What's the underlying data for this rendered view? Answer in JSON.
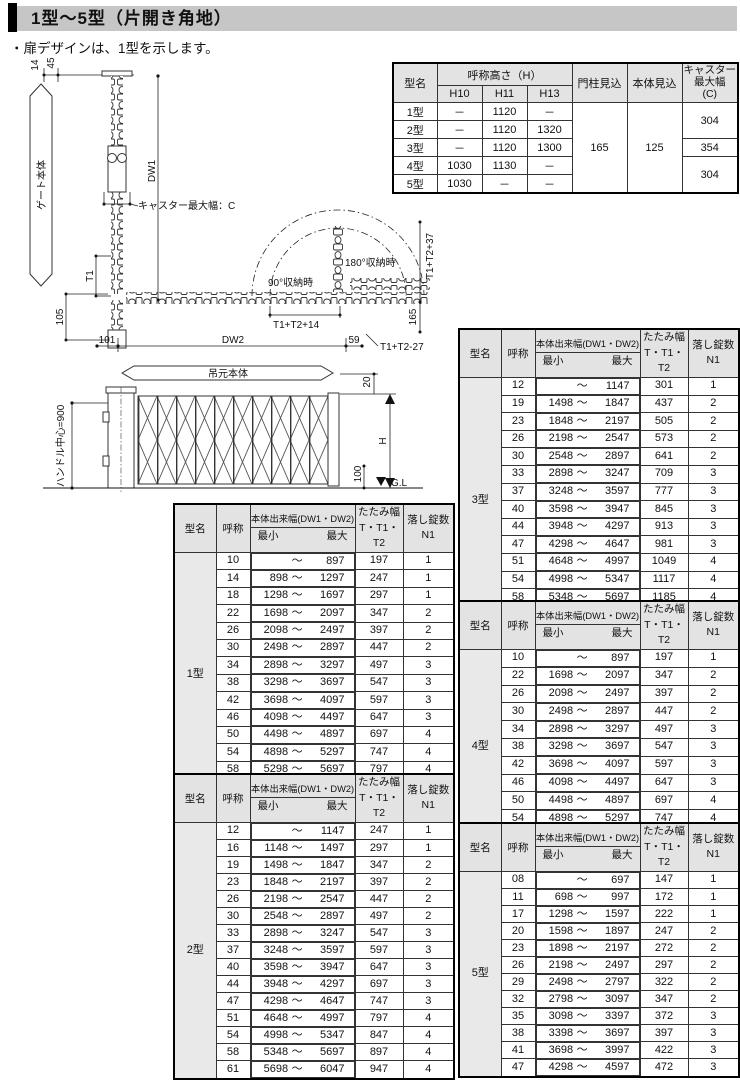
{
  "page": {
    "title": "1型～5型（片開き角地）",
    "note": "・扉デザインは、1型を示します。"
  },
  "spec_table": {
    "col_model": "型名",
    "col_height": "呼称高さ（H）",
    "col_h10": "H10",
    "col_h11": "H11",
    "col_h13": "H13",
    "col_post": "門柱見込",
    "col_body": "本体見込",
    "col_caster": "キャスター\n最大幅\n(C)",
    "rows": [
      [
        "1型",
        "－",
        "1120",
        "－"
      ],
      [
        "2型",
        "－",
        "1120",
        "1320"
      ],
      [
        "3型",
        "－",
        "1120",
        "1300"
      ],
      [
        "4型",
        "1030",
        "1130",
        "－"
      ],
      [
        "5型",
        "1030",
        "－",
        "－"
      ]
    ],
    "post_value": "165",
    "body_value": "125",
    "caster_values": [
      "304",
      "354",
      "304"
    ]
  },
  "item_table_header": {
    "model": "型名",
    "name": "呼称",
    "range": "本体出来幅(DW1・DW2)",
    "min": "最小",
    "max": "最大",
    "tilde": "～",
    "fold": "たたみ幅",
    "fold_sub": "T・T1・T2",
    "lock": "落し錠数",
    "lock_sub": "N1"
  },
  "type_tables": {
    "t1": {
      "model": "1型",
      "rows": [
        [
          "10",
          "",
          "897",
          "197",
          "1"
        ],
        [
          "14",
          "898",
          "1297",
          "247",
          "1"
        ],
        [
          "18",
          "1298",
          "1697",
          "297",
          "1"
        ],
        [
          "22",
          "1698",
          "2097",
          "347",
          "2"
        ],
        [
          "26",
          "2098",
          "2497",
          "397",
          "2"
        ],
        [
          "30",
          "2498",
          "2897",
          "447",
          "2"
        ],
        [
          "34",
          "2898",
          "3297",
          "497",
          "3"
        ],
        [
          "38",
          "3298",
          "3697",
          "547",
          "3"
        ],
        [
          "42",
          "3698",
          "4097",
          "597",
          "3"
        ],
        [
          "46",
          "4098",
          "4497",
          "647",
          "3"
        ],
        [
          "50",
          "4498",
          "4897",
          "697",
          "4"
        ],
        [
          "54",
          "4898",
          "5297",
          "747",
          "4"
        ],
        [
          "58",
          "5298",
          "5697",
          "797",
          "4"
        ],
        [
          "62",
          "5698",
          "6097",
          "847",
          "4"
        ]
      ]
    },
    "t2": {
      "model": "2型",
      "rows": [
        [
          "12",
          "",
          "1147",
          "247",
          "1"
        ],
        [
          "16",
          "1148",
          "1497",
          "297",
          "1"
        ],
        [
          "19",
          "1498",
          "1847",
          "347",
          "2"
        ],
        [
          "23",
          "1848",
          "2197",
          "397",
          "2"
        ],
        [
          "26",
          "2198",
          "2547",
          "447",
          "2"
        ],
        [
          "30",
          "2548",
          "2897",
          "497",
          "2"
        ],
        [
          "33",
          "2898",
          "3247",
          "547",
          "3"
        ],
        [
          "37",
          "3248",
          "3597",
          "597",
          "3"
        ],
        [
          "40",
          "3598",
          "3947",
          "647",
          "3"
        ],
        [
          "44",
          "3948",
          "4297",
          "697",
          "3"
        ],
        [
          "47",
          "4298",
          "4647",
          "747",
          "3"
        ],
        [
          "51",
          "4648",
          "4997",
          "797",
          "4"
        ],
        [
          "54",
          "4998",
          "5347",
          "847",
          "4"
        ],
        [
          "58",
          "5348",
          "5697",
          "897",
          "4"
        ],
        [
          "61",
          "5698",
          "6047",
          "947",
          "4"
        ]
      ]
    },
    "t3": {
      "model": "3型",
      "rows": [
        [
          "12",
          "",
          "1147",
          "301",
          "1"
        ],
        [
          "19",
          "1498",
          "1847",
          "437",
          "2"
        ],
        [
          "23",
          "1848",
          "2197",
          "505",
          "2"
        ],
        [
          "26",
          "2198",
          "2547",
          "573",
          "2"
        ],
        [
          "30",
          "2548",
          "2897",
          "641",
          "2"
        ],
        [
          "33",
          "2898",
          "3247",
          "709",
          "3"
        ],
        [
          "37",
          "3248",
          "3597",
          "777",
          "3"
        ],
        [
          "40",
          "3598",
          "3947",
          "845",
          "3"
        ],
        [
          "44",
          "3948",
          "4297",
          "913",
          "3"
        ],
        [
          "47",
          "4298",
          "4647",
          "981",
          "3"
        ],
        [
          "51",
          "4648",
          "4997",
          "1049",
          "4"
        ],
        [
          "54",
          "4998",
          "5347",
          "1117",
          "4"
        ],
        [
          "58",
          "5348",
          "5697",
          "1185",
          "4"
        ],
        [
          "61",
          "5698",
          "6047",
          "1253",
          "4"
        ]
      ]
    },
    "t4": {
      "model": "4型",
      "rows": [
        [
          "10",
          "",
          "897",
          "197",
          "1"
        ],
        [
          "22",
          "1698",
          "2097",
          "347",
          "2"
        ],
        [
          "26",
          "2098",
          "2497",
          "397",
          "2"
        ],
        [
          "30",
          "2498",
          "2897",
          "447",
          "2"
        ],
        [
          "34",
          "2898",
          "3297",
          "497",
          "3"
        ],
        [
          "38",
          "3298",
          "3697",
          "547",
          "3"
        ],
        [
          "42",
          "3698",
          "4097",
          "597",
          "3"
        ],
        [
          "46",
          "4098",
          "4497",
          "647",
          "3"
        ],
        [
          "50",
          "4498",
          "4897",
          "697",
          "4"
        ],
        [
          "54",
          "4898",
          "5297",
          "747",
          "4"
        ],
        [
          "58",
          "5298",
          "5697",
          "797",
          "4"
        ]
      ]
    },
    "t5": {
      "model": "5型",
      "rows": [
        [
          "08",
          "",
          "697",
          "147",
          "1"
        ],
        [
          "11",
          "698",
          "997",
          "172",
          "1"
        ],
        [
          "17",
          "1298",
          "1597",
          "222",
          "1"
        ],
        [
          "20",
          "1598",
          "1897",
          "247",
          "2"
        ],
        [
          "23",
          "1898",
          "2197",
          "272",
          "2"
        ],
        [
          "26",
          "2198",
          "2497",
          "297",
          "2"
        ],
        [
          "29",
          "2498",
          "2797",
          "322",
          "2"
        ],
        [
          "32",
          "2798",
          "3097",
          "347",
          "2"
        ],
        [
          "35",
          "3098",
          "3397",
          "372",
          "3"
        ],
        [
          "38",
          "3398",
          "3697",
          "397",
          "3"
        ],
        [
          "41",
          "3698",
          "3997",
          "422",
          "3"
        ],
        [
          "47",
          "4298",
          "4597",
          "472",
          "3"
        ]
      ]
    }
  },
  "diagram": {
    "top_width_a": "14",
    "top_width_b": "45",
    "gate_body": "ゲート本体",
    "dw1": "DW1",
    "caster_max": "キャスター最大幅：C",
    "t1": "T1",
    "v105": "105",
    "v101": "101",
    "dw2": "DW2",
    "v59": "59",
    "t1t2p14": "T1+T2+14",
    "t1t2m27": "T1+T2-27",
    "deg90": "90°収納時",
    "deg180": "180°収納時",
    "t1t2p37": "T1+T2+37",
    "v165": "165",
    "hanging_body": "吊元本体",
    "handle_center": "ハンドル中心=900",
    "v20": "20",
    "h": "H",
    "v100": "100",
    "gl": "G.L"
  }
}
